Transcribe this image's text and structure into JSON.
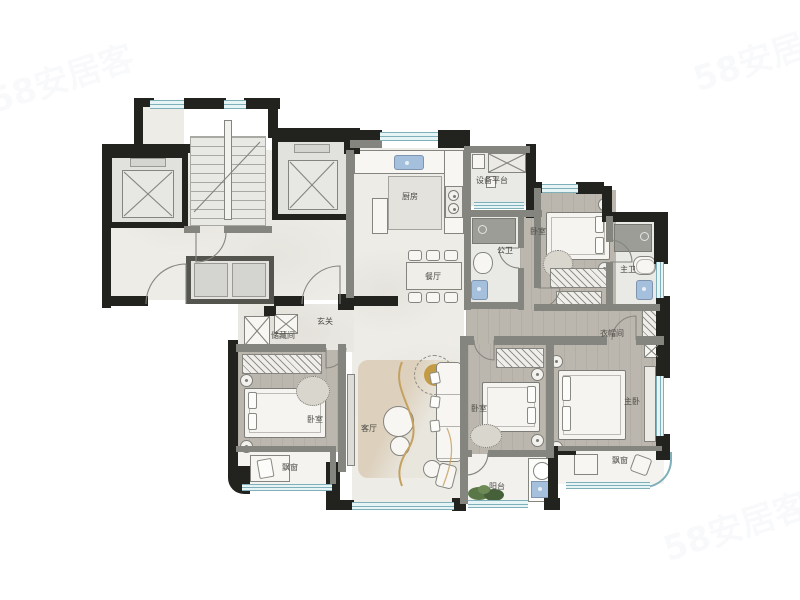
{
  "watermark": {
    "text": "58安居客"
  },
  "colors": {
    "wall": "#22221f",
    "partition": "#85857f",
    "window-frame": "#7fb0ba",
    "window-fill": "#e6f4f6",
    "floor": "#edece6",
    "wood": "#bcb7ae",
    "tile": "#e9e9e5",
    "sink": "#a4c0dc",
    "gold": "#c49b45",
    "plant": "#5a7748",
    "label": "#4c4c46"
  },
  "rooms": {
    "kitchen": "厨房",
    "equipment_platform": "设备平台",
    "dining": "餐厅",
    "guest_bath": "公卫",
    "bedroom_top": "卧室",
    "master_bath": "主卫",
    "cloakroom": "衣帽间",
    "entry": "玄关",
    "storage": "储藏间",
    "living": "客厅",
    "bedroom_left": "卧室",
    "bedroom_mid": "卧室",
    "master_bedroom": "主卧",
    "balcony": "阳台",
    "bay_window_left": "飘窗",
    "bay_window_right": "飘窗"
  }
}
